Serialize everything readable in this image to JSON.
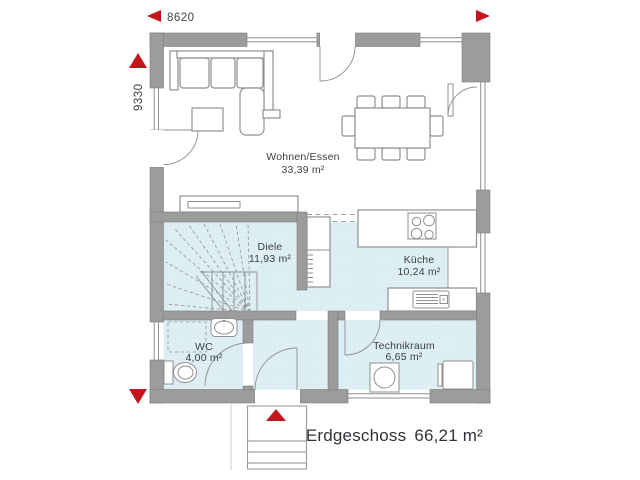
{
  "title_block": {
    "floor_label": "Erdgeschoss",
    "floor_area": "66,21 m²"
  },
  "dimensions": {
    "width_label": "8620",
    "height_label": "9330"
  },
  "rooms": [
    {
      "name": "Wohnen/Essen",
      "area": "33,39 m²"
    },
    {
      "name": "Diele",
      "area": "11,93 m²"
    },
    {
      "name": "Küche",
      "area": "10,24 m²"
    },
    {
      "name": "WC",
      "area": "4,00 m²"
    },
    {
      "name": "Technikraum",
      "area": "6,65 m²"
    }
  ],
  "colors": {
    "wall": "#9c9c9c",
    "tile_floor": "#d9edf3",
    "tile_grid": "#e9f4f8",
    "accent_red": "#c3161c",
    "line": "#8f8f8f",
    "label_text": "#3f3f3f",
    "footer_text": "#2f3338"
  }
}
